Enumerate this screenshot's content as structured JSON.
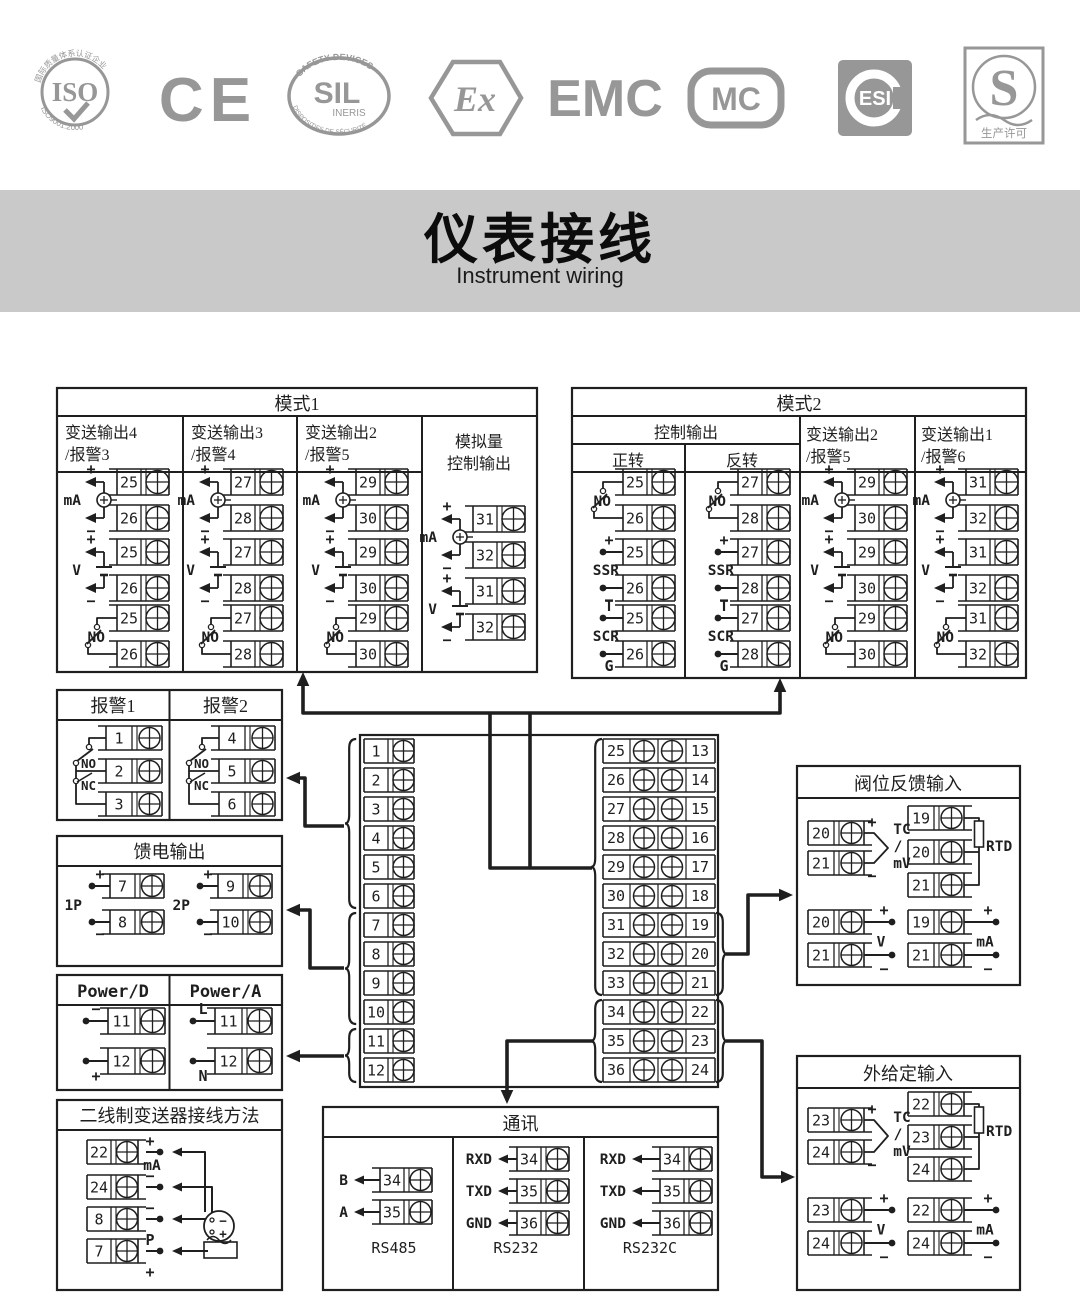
{
  "colors": {
    "ink": "#1f1f1f",
    "logo": "#979797",
    "banner": "#c9c9c9",
    "paper": "#ffffff"
  },
  "logos": [
    {
      "label": "ISO",
      "arc_top": "国际质量体系认证企业",
      "arc_bottom": "ISO9001:2000"
    },
    {
      "label": "CE"
    },
    {
      "label": "SIL",
      "sub": "INERIS",
      "arc_top": "SAFETY DEVICES",
      "arc_bottom": "DISPOSITIFS DE SÉCURITÉ"
    },
    {
      "label": "Ex"
    },
    {
      "label": "EMC"
    },
    {
      "label": "MC"
    },
    {
      "label": "ESI"
    },
    {
      "label": "S",
      "sub": "生产许可"
    }
  ],
  "banner": {
    "title": "仪表接线",
    "subtitle": "Instrument wiring"
  },
  "mode1": {
    "title": "模式1",
    "columns": [
      {
        "h1": "变送输出4",
        "h2": "/报警3",
        "groups": [
          {
            "t": "mA",
            "l": "mA",
            "n": [
              "25",
              "26"
            ]
          },
          {
            "t": "V",
            "l": "V",
            "n": [
              "25",
              "26"
            ]
          },
          {
            "t": "NO",
            "l": "NO",
            "n": [
              "25",
              "26"
            ]
          }
        ]
      },
      {
        "h1": "变送输出3",
        "h2": "/报警4",
        "groups": [
          {
            "t": "mA",
            "l": "mA",
            "n": [
              "27",
              "28"
            ]
          },
          {
            "t": "V",
            "l": "V",
            "n": [
              "27",
              "28"
            ]
          },
          {
            "t": "NO",
            "l": "NO",
            "n": [
              "27",
              "28"
            ]
          }
        ]
      },
      {
        "h1": "变送输出2",
        "h2": "/报警5",
        "groups": [
          {
            "t": "mA",
            "l": "mA",
            "n": [
              "29",
              "30"
            ]
          },
          {
            "t": "V",
            "l": "V",
            "n": [
              "29",
              "30"
            ]
          },
          {
            "t": "NO",
            "l": "NO",
            "n": [
              "29",
              "30"
            ]
          }
        ]
      },
      {
        "h1": "模拟量",
        "h2": "控制输出",
        "groups": [
          {
            "t": "mA",
            "l": "mA",
            "n": [
              "31",
              "32"
            ]
          },
          {
            "t": "V",
            "l": "V",
            "n": [
              "31",
              "32"
            ]
          }
        ]
      }
    ]
  },
  "mode2": {
    "title": "模式2",
    "ctrl_header": "控制输出",
    "sub1": "正转",
    "sub2": "反转",
    "col3h1": "变送输出2",
    "col3h2": "/报警5",
    "col4h1": "变送输出1",
    "col4h2": "/报警6",
    "columns": [
      {
        "groups": [
          {
            "t": "NO",
            "l": "NO",
            "n": [
              "25",
              "26"
            ]
          },
          {
            "t": "SSR",
            "l": "SSR",
            "top": "+",
            "bot": "−",
            "n": [
              "25",
              "26"
            ]
          },
          {
            "t": "SCR",
            "l": "SCR",
            "top": "T",
            "bot": "G",
            "n": [
              "25",
              "26"
            ]
          }
        ]
      },
      {
        "groups": [
          {
            "t": "NO",
            "l": "NO",
            "n": [
              "27",
              "28"
            ]
          },
          {
            "t": "SSR",
            "l": "SSR",
            "top": "+",
            "bot": "−",
            "n": [
              "27",
              "28"
            ]
          },
          {
            "t": "SCR",
            "l": "SCR",
            "top": "T",
            "bot": "G",
            "n": [
              "27",
              "28"
            ]
          }
        ]
      },
      {
        "groups": [
          {
            "t": "mA",
            "l": "mA",
            "n": [
              "29",
              "30"
            ]
          },
          {
            "t": "V",
            "l": "V",
            "n": [
              "29",
              "30"
            ]
          },
          {
            "t": "NO",
            "l": "NO",
            "n": [
              "29",
              "30"
            ]
          }
        ]
      },
      {
        "groups": [
          {
            "t": "mA",
            "l": "mA",
            "n": [
              "31",
              "32"
            ]
          },
          {
            "t": "V",
            "l": "V",
            "n": [
              "31",
              "32"
            ]
          },
          {
            "t": "NO",
            "l": "NO",
            "n": [
              "31",
              "32"
            ]
          }
        ]
      }
    ]
  },
  "alarms": {
    "titles": [
      "报警1",
      "报警2"
    ],
    "no": "NO",
    "nc": "NC",
    "groups": [
      [
        "1",
        "2",
        "3"
      ],
      [
        "4",
        "5",
        "6"
      ]
    ]
  },
  "feed": {
    "title": "馈电输出",
    "plus": "+",
    "minus": "−",
    "groups": [
      {
        "label": "1P",
        "n": [
          "7",
          "8"
        ]
      },
      {
        "label": "2P",
        "n": [
          "9",
          "10"
        ]
      }
    ]
  },
  "power": {
    "headers": [
      "Power/D",
      "Power/A"
    ],
    "cols": [
      [
        {
          "n": "11",
          "sign": "−",
          "pos": "above"
        },
        {
          "n": "12",
          "sign": "+",
          "pos": "below"
        }
      ],
      [
        {
          "n": "11",
          "sign": "L",
          "pos": "above"
        },
        {
          "n": "12",
          "sign": "N",
          "pos": "below"
        }
      ]
    ]
  },
  "twowire": {
    "title": "二线制变送器接线方法",
    "mid_label": "mA",
    "rows": [
      {
        "n": "22",
        "above": "+"
      },
      {
        "n": "24",
        "above": "−"
      },
      {
        "n": "8",
        "above": "−"
      },
      {
        "n": "7",
        "above": "P",
        "below": "+"
      }
    ],
    "sensor": {
      "top": "−",
      "bottom": "+"
    }
  },
  "strip": {
    "left": [
      "1",
      "2",
      "3",
      "4",
      "5",
      "6",
      "7",
      "8",
      "9",
      "10",
      "11",
      "12"
    ],
    "mid": [
      "25",
      "26",
      "27",
      "28",
      "29",
      "30",
      "31",
      "32",
      "33",
      "34",
      "35",
      "36"
    ],
    "right": [
      "13",
      "14",
      "15",
      "16",
      "17",
      "18",
      "19",
      "20",
      "21",
      "22",
      "23",
      "24"
    ]
  },
  "comm": {
    "title": "通讯",
    "sections": [
      {
        "caption": "RS485",
        "rows": [
          {
            "sig": "B",
            "n": "34"
          },
          {
            "sig": "A",
            "n": "35"
          }
        ]
      },
      {
        "caption": "RS232",
        "rows": [
          {
            "sig": "RXD",
            "n": "34"
          },
          {
            "sig": "TXD",
            "n": "35"
          },
          {
            "sig": "GND",
            "n": "36"
          }
        ]
      },
      {
        "caption": "RS232C",
        "rows": [
          {
            "sig": "RXD",
            "n": "34"
          },
          {
            "sig": "TXD",
            "n": "35"
          },
          {
            "sig": "GND",
            "n": "36"
          }
        ]
      }
    ]
  },
  "valve": {
    "title": "阀位反馈输入",
    "tc": {
      "lines": [
        "TC",
        "/",
        "mV"
      ],
      "n": [
        "20",
        "21"
      ]
    },
    "rtd": {
      "label": "RTD",
      "n": [
        "19",
        "20",
        "21"
      ]
    },
    "v": {
      "label": "V",
      "n": [
        "20",
        "21"
      ]
    },
    "ma": {
      "label": "mA",
      "n": [
        "19",
        "21"
      ]
    }
  },
  "ext": {
    "title": "外给定输入",
    "tc": {
      "lines": [
        "TC",
        "/",
        "mV"
      ],
      "n": [
        "23",
        "24"
      ]
    },
    "rtd": {
      "label": "RTD",
      "n": [
        "22",
        "23",
        "24"
      ]
    },
    "v": {
      "label": "V",
      "n": [
        "23",
        "24"
      ]
    },
    "ma": {
      "label": "mA",
      "n": [
        "22",
        "24"
      ]
    }
  },
  "signs": {
    "plus": "+",
    "minus": "−"
  }
}
